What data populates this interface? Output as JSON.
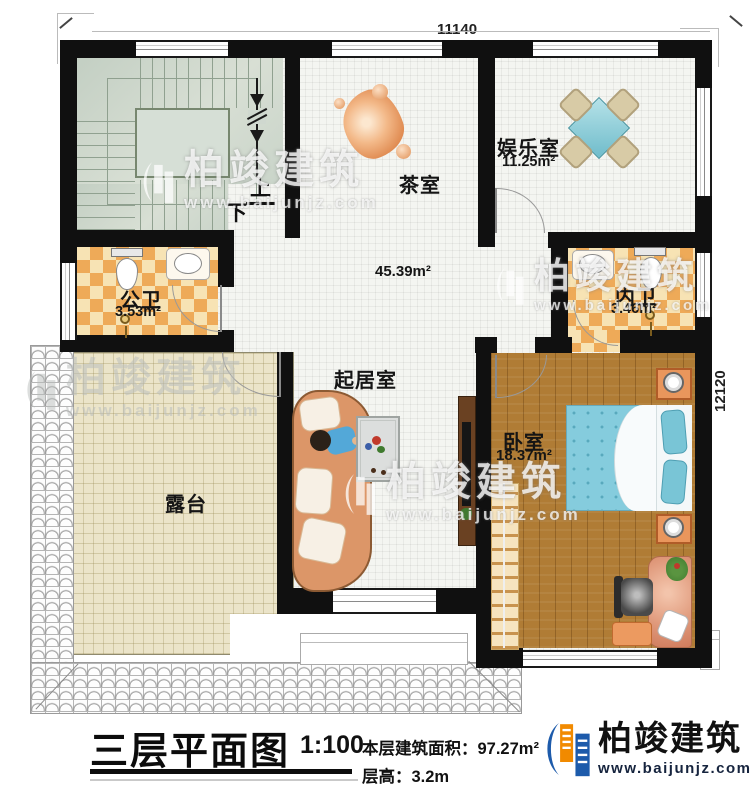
{
  "plan": {
    "dimensions": {
      "top": "11140",
      "right": "12120"
    },
    "stair": {
      "up_label": "上",
      "down_label": "下"
    },
    "rooms": [
      {
        "id": "tea-room",
        "name": "茶室",
        "area": ""
      },
      {
        "id": "entertainment",
        "name": "娱乐室",
        "area": "11.25m²"
      },
      {
        "id": "hall",
        "name": "",
        "area": "45.39m²"
      },
      {
        "id": "public-bath",
        "name": "公卫",
        "area": "3.53m²"
      },
      {
        "id": "private-bath",
        "name": "内卫",
        "area": "3.46m²"
      },
      {
        "id": "living-room",
        "name": "起居室",
        "area": ""
      },
      {
        "id": "bedroom",
        "name": "卧室",
        "area": "18.37m²"
      },
      {
        "id": "terrace",
        "name": "露台",
        "area": ""
      }
    ]
  },
  "titleblock": {
    "title": "三层平面图",
    "scale": "1:100",
    "area_label": "本层建筑面积：97.27m²",
    "height_label": "层高：3.2m"
  },
  "logo": {
    "name": "柏竣建筑",
    "url": "www.baijunjz.com"
  },
  "watermark": {
    "name": "柏竣建筑",
    "url": "www.baijunjz.com"
  },
  "colors": {
    "wall": "#101010",
    "bath_checker_orange": "#eeaa58",
    "bath_checker_cream": "#f7e3b4",
    "wood_floor": "#b07c35",
    "stair_floor": "#c9d4c9",
    "terrace_floor": "#ebe4c9",
    "bed_blue": "#85ccdd",
    "sofa_orange": "#dc9668",
    "logo_blue": "#1d5bab",
    "logo_orange": "#f18a00"
  }
}
